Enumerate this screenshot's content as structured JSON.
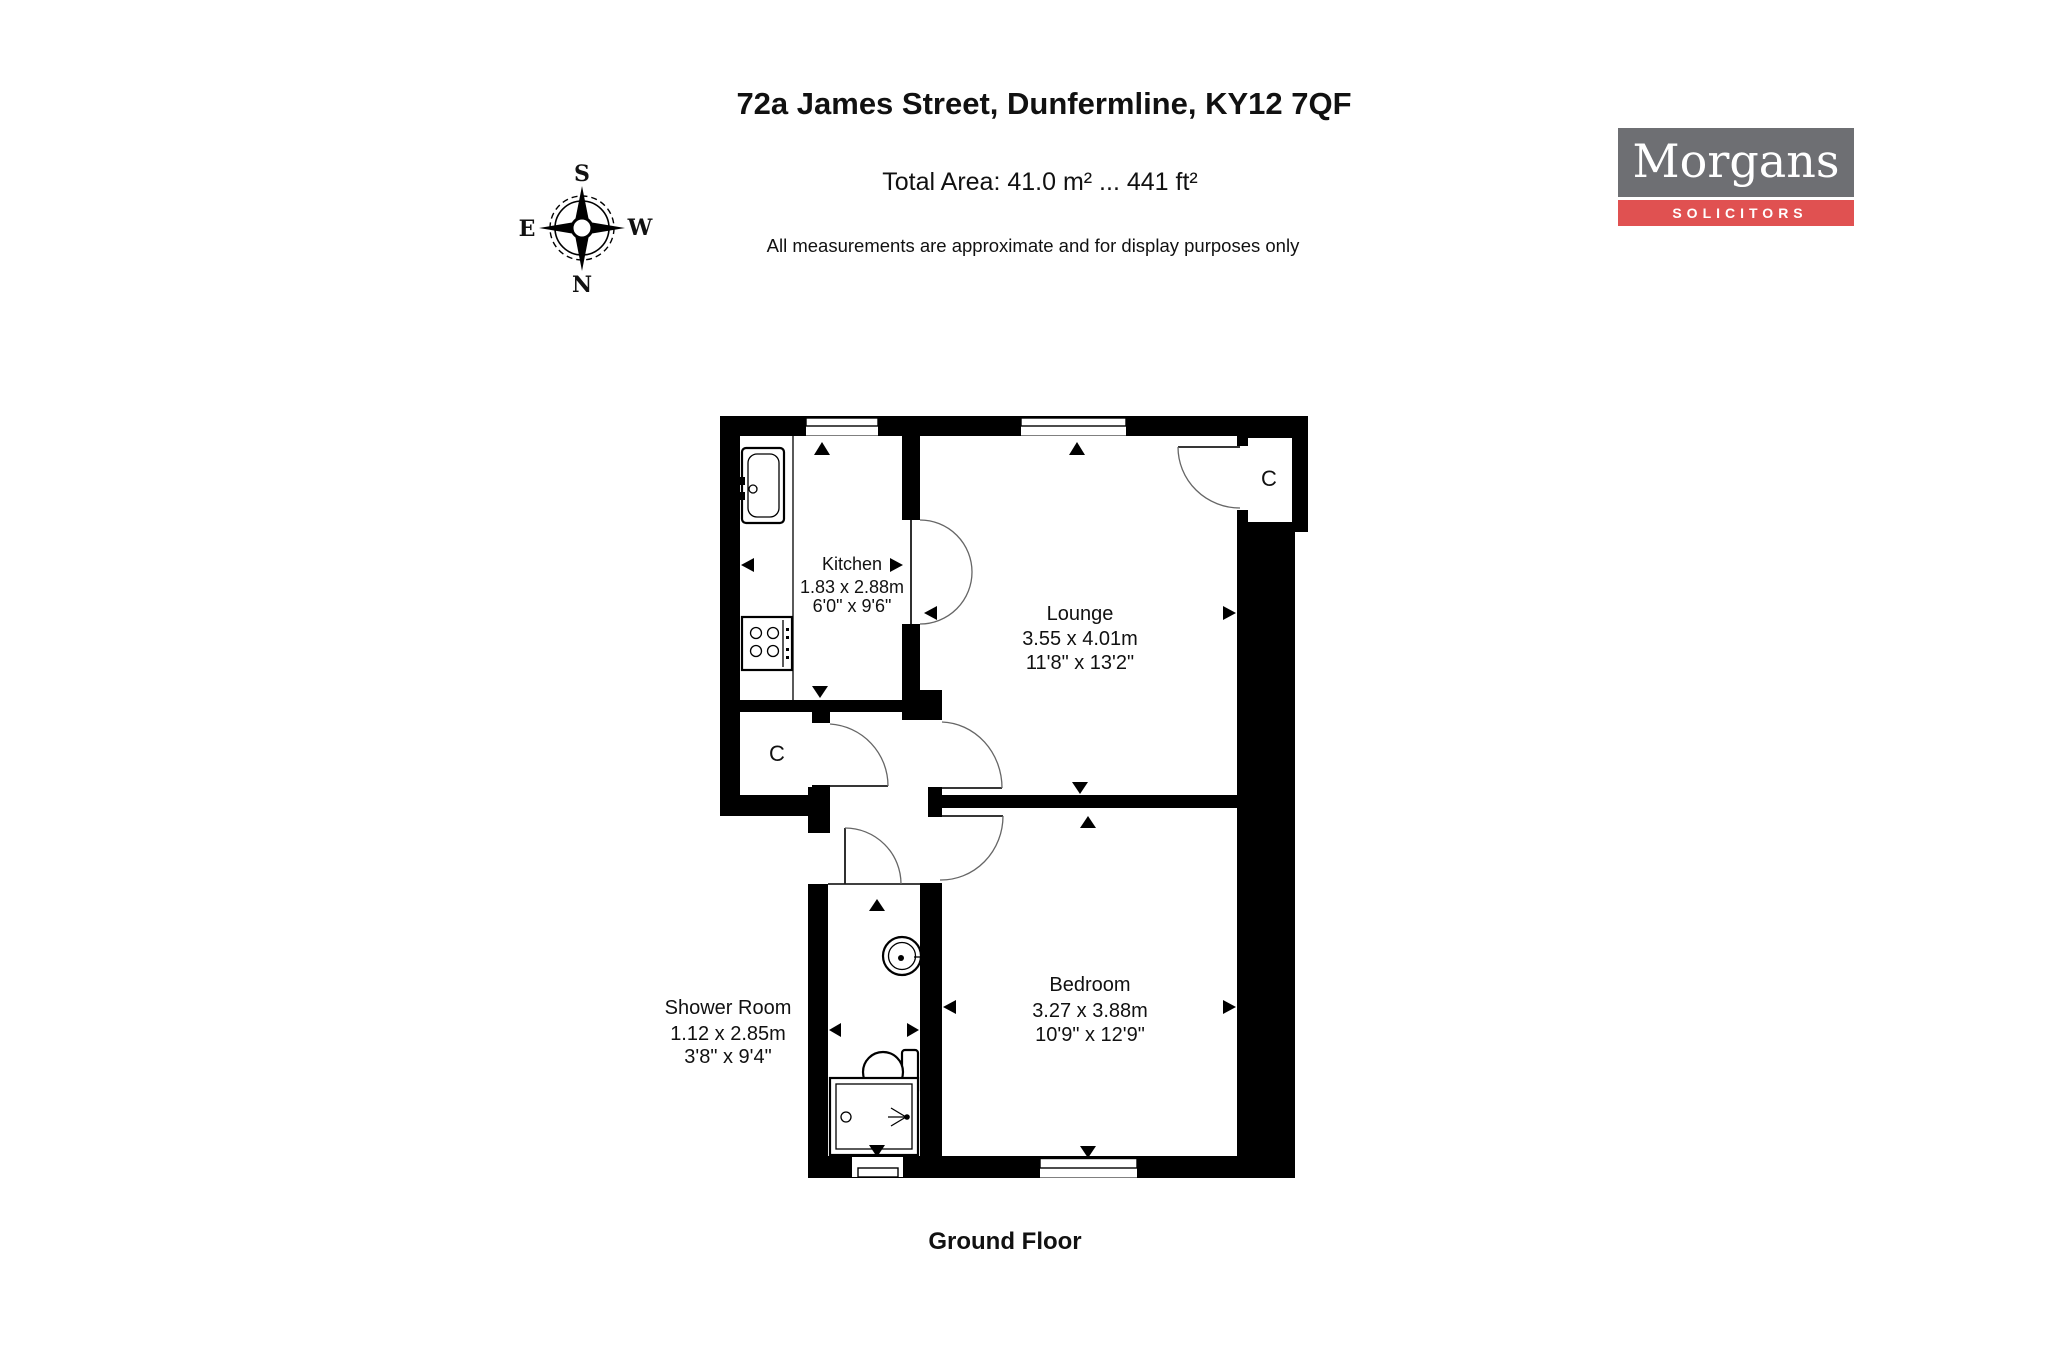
{
  "header": {
    "title": "72a James Street, Dunfermline, KY12 7QF",
    "total_area": "Total Area: 41.0 m² ... 441 ft²",
    "disclaimer": "All measurements are approximate and for display purposes only"
  },
  "floor_label": "Ground Floor",
  "logo": {
    "name": "Morgans",
    "tagline": "SOLICITORS",
    "colors": {
      "gray": "#6e6f73",
      "red": "#e05151",
      "text": "#ffffff"
    }
  },
  "compass": {
    "top": "S",
    "bottom": "N",
    "left": "E",
    "right": "W"
  },
  "rooms": {
    "kitchen": {
      "name": "Kitchen",
      "metric": "1.83 x 2.88m",
      "imperial": "6'0\" x 9'6\""
    },
    "lounge": {
      "name": "Lounge",
      "metric": "3.55 x 4.01m",
      "imperial": "11'8\" x 13'2\""
    },
    "bedroom": {
      "name": "Bedroom",
      "metric": "3.27 x 3.88m",
      "imperial": "10'9\" x 12'9\""
    },
    "shower_room": {
      "name": "Shower Room",
      "metric": "1.12 x 2.85m",
      "imperial": "3'8\" x 9'4\""
    },
    "closet_label": "C"
  }
}
